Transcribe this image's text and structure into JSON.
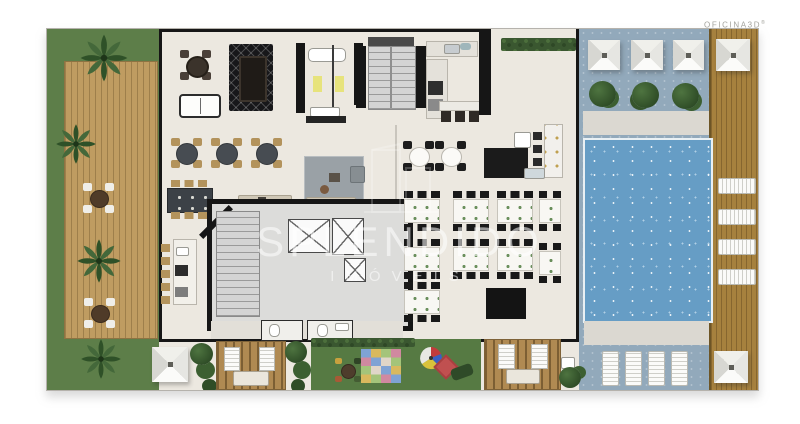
{
  "brand": {
    "name": "OFICINA3D",
    "mark": "®"
  },
  "watermark": {
    "title": "SPLENDIDO",
    "subtitle": "IMÓVEIS"
  },
  "palette": {
    "page_bg": "#ffffff",
    "floor": "#ece8e0",
    "grass": "#5d7e49",
    "wood_deck": "#bf9c61",
    "wood_deck_side": "#a6813e",
    "pool_water": "#669dc5",
    "pool_deck": "#92a9bb",
    "wall": "#161616",
    "rug_dark": "#17171a",
    "rug_gray": "#9aa1a6",
    "accent_yellow": "#e6e26a",
    "watermark_color": "rgba(255,255,255,0.55)",
    "brand_color": "#a3a39d"
  }
}
